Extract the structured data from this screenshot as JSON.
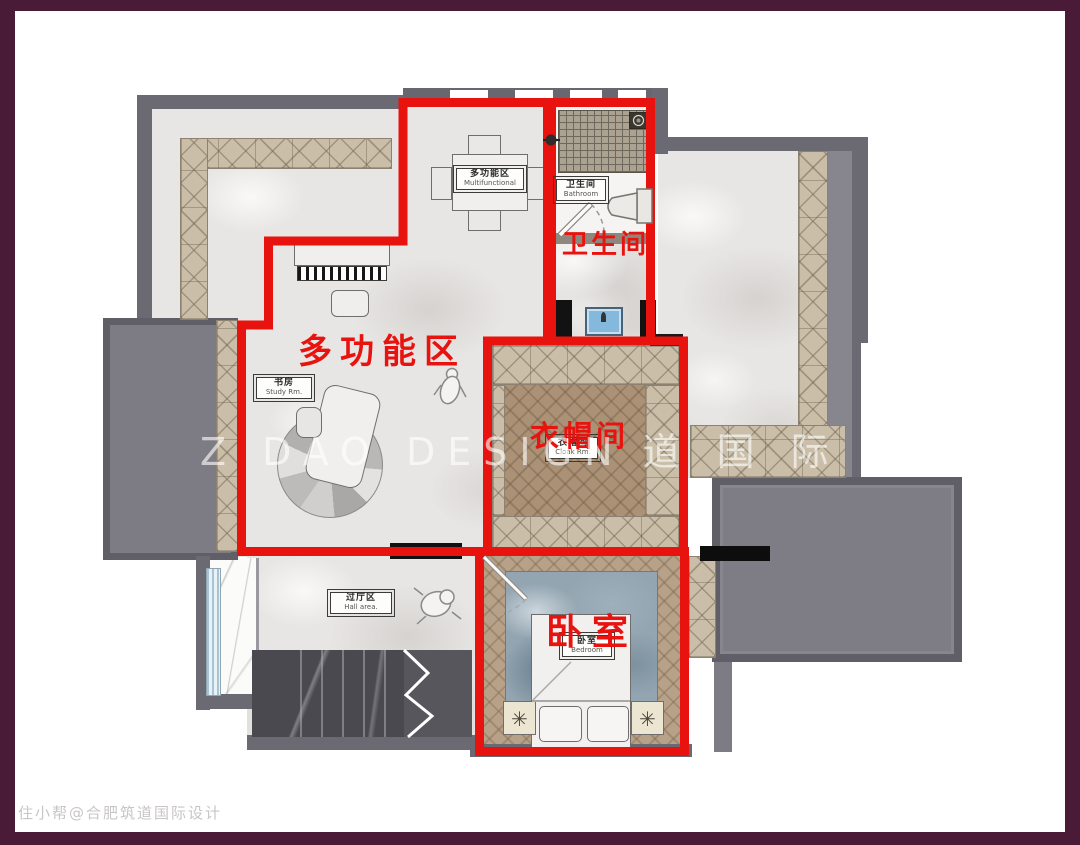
{
  "meta": {
    "type": "interior floor plan rendering"
  },
  "palette": {
    "frame": "#4a1b37",
    "paper": "#ffffff",
    "wall": "#6b6a73",
    "wall_fill": "#7d7c85",
    "red": "#e8130f",
    "cabinet": "#cabea9",
    "wood": "#ab9277",
    "wood_light": "#b7a189",
    "marble": "#e8e6e4",
    "stairs": "#4a494f",
    "sink_blue": "#85b9dc",
    "window_blue": "#bdd5e2"
  },
  "overlay_labels": {
    "multifunction": "多功能区",
    "bathroom": "卫生间",
    "cloakroom": "衣帽间",
    "bedroom": "卧室"
  },
  "room_tags": {
    "table": {
      "cn": "多功能区",
      "en": "Multifunctional"
    },
    "study": {
      "cn": "书房",
      "en": "Study Rm."
    },
    "bathroom": {
      "cn": "卫生间",
      "en": "Bathroom"
    },
    "cloakroom": {
      "cn": "衣帽间",
      "en": "Cloak Rm."
    },
    "bedroom": {
      "cn": "卧室",
      "en": "Bedroom"
    },
    "hall": {
      "cn": "过厅区",
      "en": "Hall area."
    }
  },
  "watermark": {
    "latin": "Z DAO DESIGN",
    "cjk": "道 国 际 设 计"
  },
  "credit": "住小帮@合肥筑道国际设计",
  "icons": {
    "lamp_glyph": "✳"
  }
}
